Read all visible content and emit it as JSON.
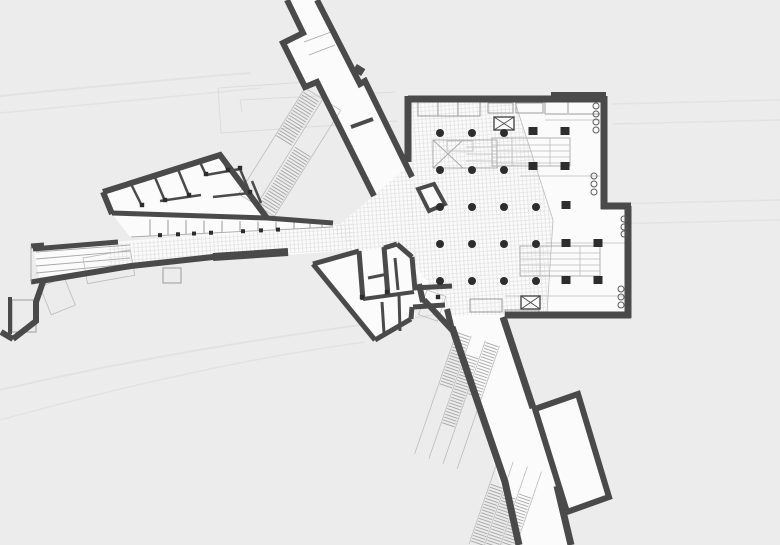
{
  "document": {
    "kind": "architectural floor plan",
    "subject": "underground station concourse with corridors, escalators and column grid",
    "visible_text": ""
  },
  "colors": {
    "background": "#ececec",
    "wall": "#4a4a4a",
    "floor": "#fbfbfb",
    "grid": "#d9d9d9",
    "detail": "#a8a8a8",
    "faint": "#e2e2e2",
    "ink": "#2d2d2d"
  },
  "plan": {
    "round_columns": [
      [
        440,
        133
      ],
      [
        472,
        133
      ],
      [
        504,
        133
      ],
      [
        440,
        170
      ],
      [
        472,
        170
      ],
      [
        504,
        170
      ],
      [
        440,
        207
      ],
      [
        472,
        207
      ],
      [
        504,
        207
      ],
      [
        536,
        207
      ],
      [
        440,
        244
      ],
      [
        472,
        244
      ],
      [
        504,
        244
      ],
      [
        536,
        244
      ],
      [
        440,
        281
      ],
      [
        472,
        281
      ],
      [
        504,
        281
      ],
      [
        536,
        281
      ]
    ],
    "square_columns": [
      [
        533,
        131
      ],
      [
        565,
        131
      ],
      [
        533,
        166
      ],
      [
        565,
        166
      ],
      [
        566,
        205
      ],
      [
        566,
        243
      ],
      [
        598,
        243
      ],
      [
        566,
        280
      ],
      [
        598,
        280
      ]
    ],
    "wall_circles": [
      [
        596,
        106
      ],
      [
        596,
        114
      ],
      [
        596,
        122
      ],
      [
        596,
        130
      ],
      [
        594,
        176
      ],
      [
        594,
        184
      ],
      [
        594,
        192
      ],
      [
        624,
        219
      ],
      [
        624,
        227
      ],
      [
        624,
        234
      ],
      [
        621,
        289
      ],
      [
        621,
        297
      ],
      [
        621,
        305
      ]
    ],
    "block_door_posts": [
      [
        142,
        205
      ],
      [
        165,
        200
      ],
      [
        189,
        195
      ],
      [
        206,
        174
      ],
      [
        240,
        168
      ],
      [
        250,
        192
      ],
      [
        228,
        170
      ]
    ],
    "cluster_door_posts": [
      [
        362,
        297
      ],
      [
        387,
        292
      ],
      [
        438,
        297
      ]
    ],
    "shop_door_ticks_x": [
      160,
      178,
      194,
      211,
      243,
      261,
      278
    ],
    "shop_divider_x": [
      150,
      168,
      186,
      204,
      222,
      240,
      258,
      276,
      294,
      310,
      322
    ]
  }
}
